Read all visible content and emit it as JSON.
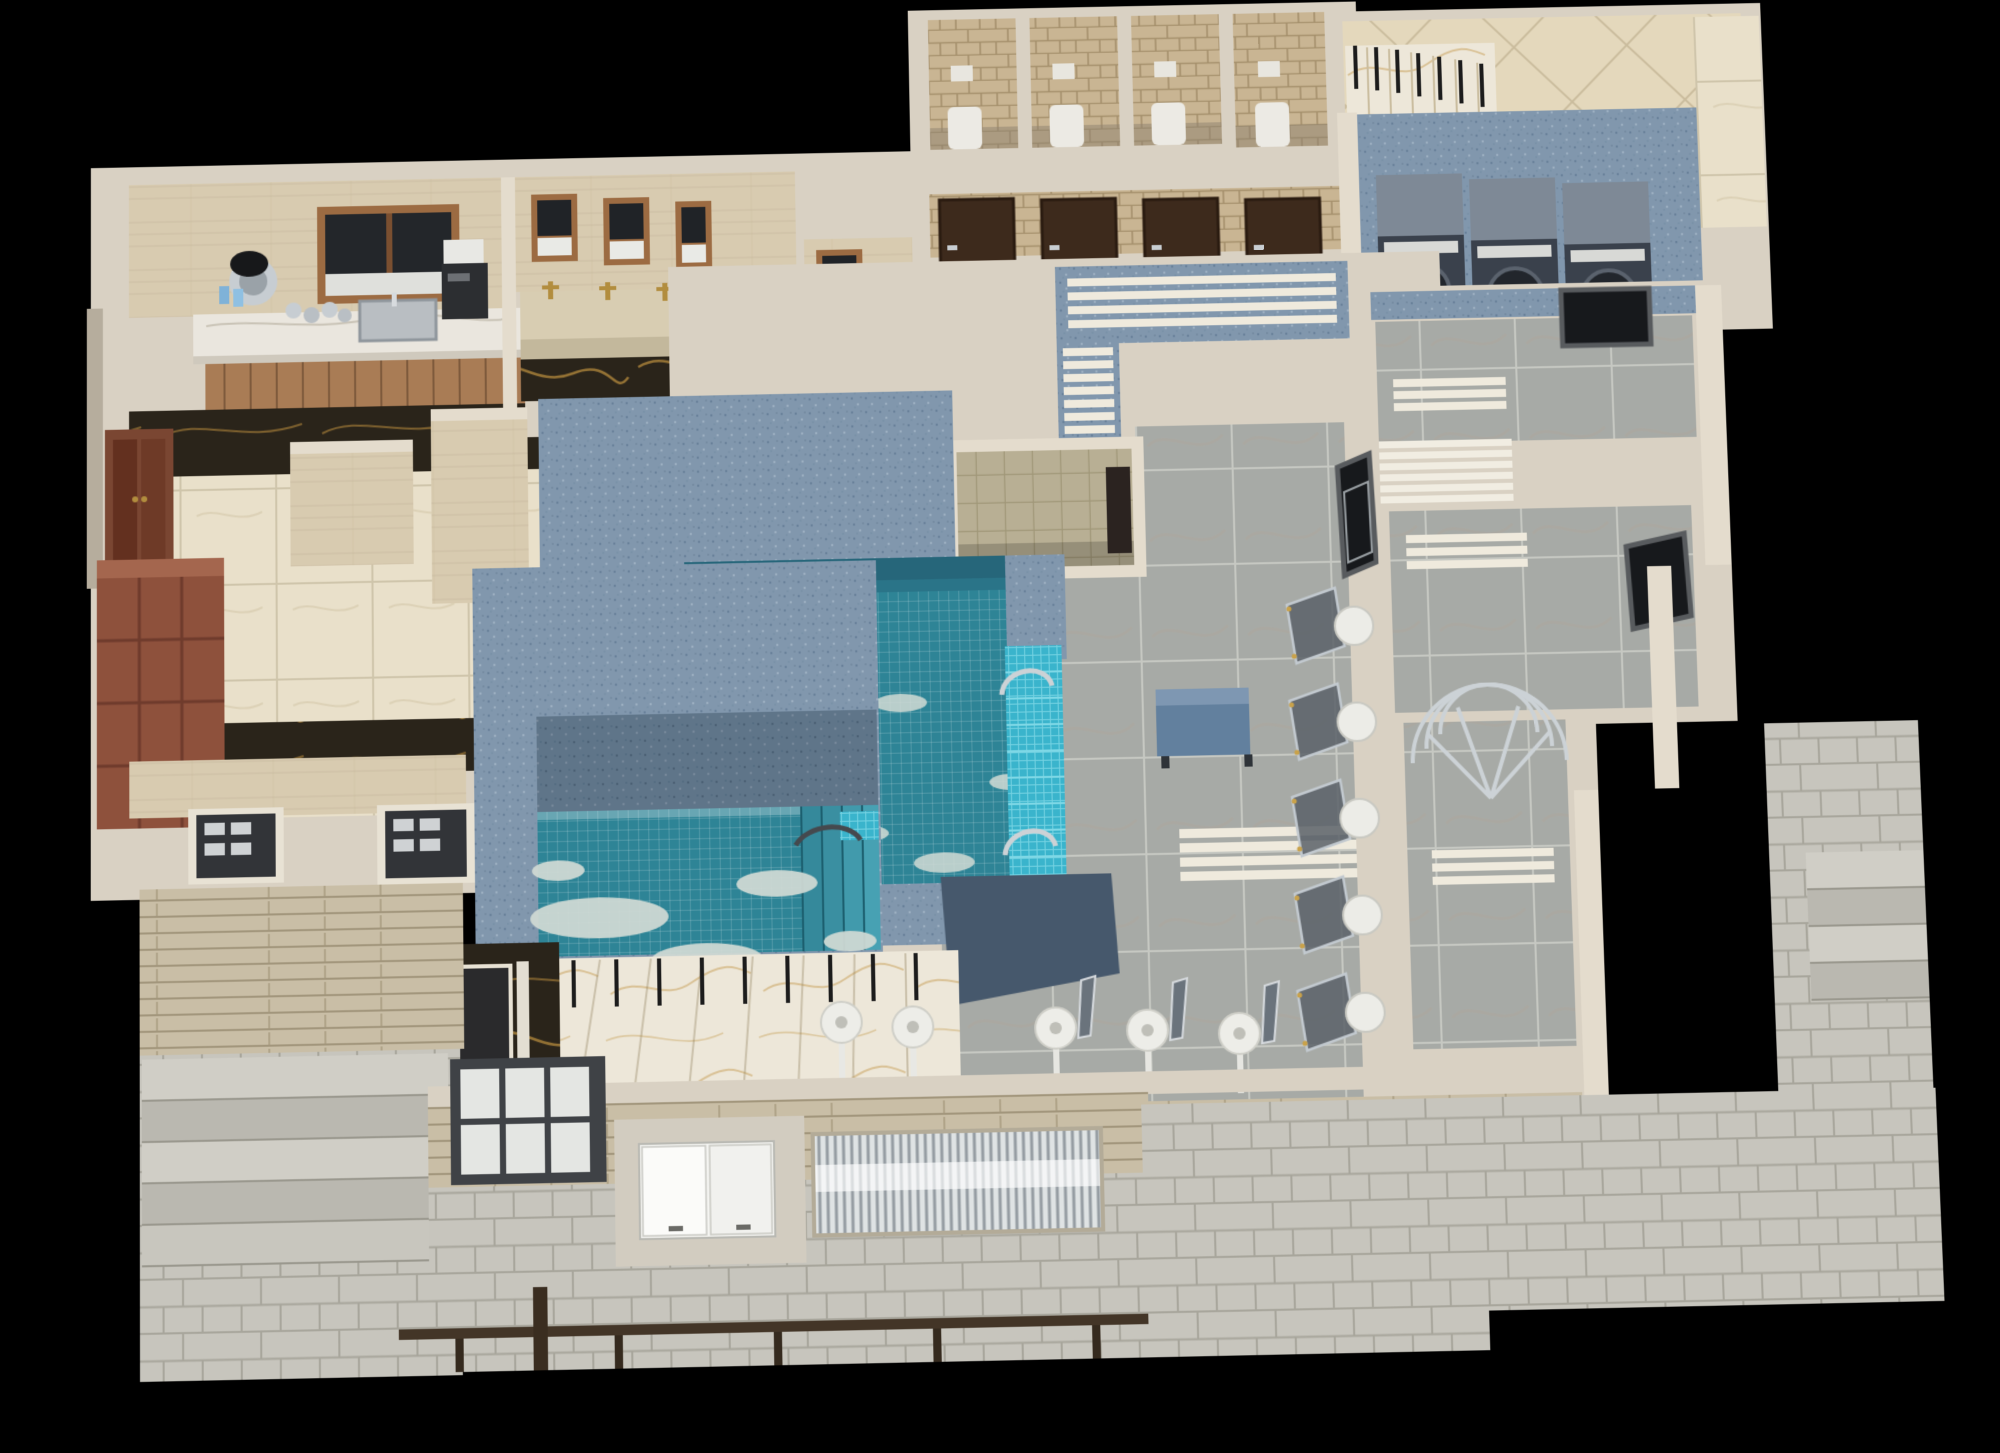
{
  "scene": {
    "type": "3d-floorplan-cutaway-render",
    "subject": "spa-bathhouse-pool-facility",
    "rooms": [
      {
        "name": "kitchen-bar",
        "features": [
          "marble-counter",
          "wood-cabinets",
          "service-window",
          "coffee-urn",
          "sink",
          "coffee-machine"
        ]
      },
      {
        "name": "washbasin-area",
        "features": [
          "stone-trough-sink",
          "gold-faucets",
          "framed-mirrors"
        ],
        "mirror_count": 3,
        "faucet_count": 4
      },
      {
        "name": "wc-room",
        "features": [
          "toilet",
          "mirror"
        ]
      },
      {
        "name": "locker-changing-area",
        "features": [
          "red-wood-lockers",
          "double-entrance-door",
          "black-gold-marble-floor",
          "beige-tile-floor"
        ]
      },
      {
        "name": "toilet-stall-block",
        "stall_count": 4,
        "features": [
          "brick-walls",
          "white-toilets",
          "cisterns",
          "dark-brown-doors"
        ],
        "corridor_door_count": 4
      },
      {
        "name": "entry-hall",
        "features": [
          "diagonal-beige-tiles",
          "marble-staircase",
          "black-railing-posts"
        ]
      },
      {
        "name": "laundry-room",
        "washing_machine_count": 3,
        "features": [
          "blue-speckled-walls"
        ]
      },
      {
        "name": "pool-hall",
        "features": [
          "white-slat-benches",
          "gray-marble-floor",
          "upper-pool",
          "lower-pool",
          "cyan-mosaic-steps",
          "chrome-handrails",
          "pink-accent-wall"
        ]
      },
      {
        "name": "sauna-room",
        "features": [
          "khaki-tile-walls",
          "dark-door"
        ]
      },
      {
        "name": "shower-corridor",
        "wall_shower_count": 5,
        "features": [
          "curved-glass-panels",
          "round-white-shower-heads",
          "dark-window"
        ]
      },
      {
        "name": "relaxation-rooms",
        "features": [
          "white-slat-racks",
          "towel-radiator",
          "curved-chrome-towel-rack",
          "blue-bench",
          "dark-windows"
        ]
      },
      {
        "name": "lower-deck",
        "features": [
          "gold-veined-marble-stairs",
          "black-railing-posts",
          "navy-wall-panel",
          "freestanding-showers"
        ],
        "freestanding_shower_count": 5
      },
      {
        "name": "exterior-terrace",
        "features": [
          "stone-pavers",
          "stone-clad-walls",
          "grid-window",
          "white-gloss-cabinet",
          "chrome-slat-grille",
          "wood-railing",
          "stairs-left",
          "stairs-right"
        ]
      }
    ]
  },
  "palette": {
    "bg": "#000000",
    "wall-top": "#d9d1c3",
    "wall-light": "#e4dccd",
    "wall-face": "#b6ad9d",
    "travertine": "#d8cbb0",
    "beige-tile": "#e9e0ca",
    "black-marble": "#2a241a",
    "gold-vein": "#a07a36",
    "wood-cabinet": "#a97c55",
    "wood-frame": "#9c6b42",
    "brick": "#c9b593",
    "door-brown": "#3d2a1c",
    "plank": "#8f6e4e",
    "blue-wall": "#8197ad",
    "blue-wall-dark": "#5f7589",
    "navy-panel": "#46586c",
    "gray-floor": "#a7aaa6",
    "laundry-floor": "#8d99a4",
    "washer-top": "#7e8996",
    "washer-front": "#3a414c",
    "water": "#2e8496",
    "water-deep": "#26667a",
    "foam": "#d2dbd5",
    "cyan-mosaic": "#3ab4cc",
    "pink-wall": "#c9897b",
    "gold": "#b28d3e",
    "chrome": "#ccd2d6",
    "white-gloss": "#f4f4f1",
    "marble-white": "#ede7d9",
    "post-black": "#1c1c1c",
    "pavement": "#c7c5bd",
    "stone-wall": "#c9bea6",
    "concrete": "#d2ccc0",
    "rail-wood": "#433527",
    "khaki-tile": "#b8af94",
    "locker": "#8e513c",
    "locker-top": "#a4664e",
    "door-dark": "#323438",
    "white-slat": "#efeadd"
  }
}
